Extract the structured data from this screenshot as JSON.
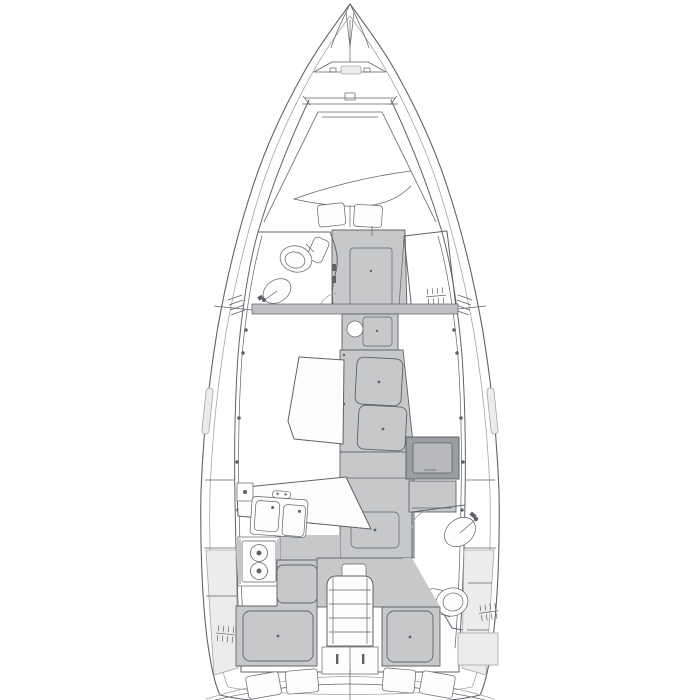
{
  "diagram": {
    "label": "Sailing yacht interior layout floor plan, top view, bow up",
    "type": "boat-floor-plan",
    "orientation": "bow-up"
  },
  "colors": {
    "paper": "#ffffff",
    "line": "#5f6368",
    "line_light": "#a2a6aa",
    "furniture": "#c6c8ca",
    "band": "#bdbfc2",
    "dark_box": "#9a9da1",
    "dark_box_inner": "#b7b9bc",
    "deck_panel": "#ececed",
    "white": "#fdfdfe"
  },
  "elements": [
    {
      "name": "bow-pulpit-and-forestay",
      "label": "Bow pulpit and forestay fitting"
    },
    {
      "name": "anchor-locker-windlass",
      "label": "Anchor locker hatch with windlass"
    },
    {
      "name": "forward-cabin-vberth",
      "label": "Forward cabin V-berth with two pillows"
    },
    {
      "name": "forward-head",
      "label": "Forward head with toilet and washbasin"
    },
    {
      "name": "forward-wardrobe",
      "label": "Starboard hanging wardrobe"
    },
    {
      "name": "passageway-door",
      "label": "Forward cabin doorway and sole"
    },
    {
      "name": "mast-cabinet",
      "label": "Mast-step cabinet with round sink"
    },
    {
      "name": "saloon-table",
      "label": "Saloon dining table"
    },
    {
      "name": "centerline-settee",
      "label": "Centerline settee with two cushions"
    },
    {
      "name": "galley",
      "label": "Galley: countertop, double sink, two-burner stove"
    },
    {
      "name": "fridge",
      "label": "Top-loading fridge box"
    },
    {
      "name": "aft-head",
      "label": "Aft head with toilet, washbasin and hanging locker"
    },
    {
      "name": "companionway-steps",
      "label": "Companionway ladder with stowage drawers"
    },
    {
      "name": "aft-cabin-port",
      "label": "Port aft double cabin"
    },
    {
      "name": "aft-cabin-starboard",
      "label": "Starboard aft double cabin"
    },
    {
      "name": "transom",
      "label": "Transom arcs with berth pillows"
    }
  ]
}
